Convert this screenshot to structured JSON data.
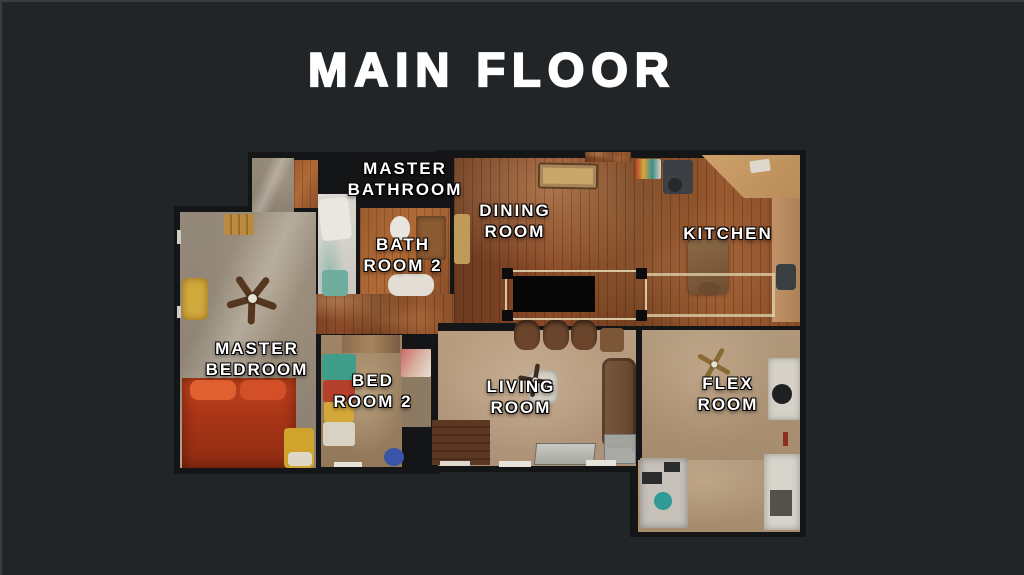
{
  "title": "MAIN FLOOR",
  "rooms": {
    "master_bathroom": {
      "line1": "MASTER",
      "line2": "BATHROOM"
    },
    "bath_room_2": {
      "line1": "BATH",
      "line2": "ROOM 2"
    },
    "dining_room": {
      "line1": "DINING",
      "line2": "ROOM"
    },
    "kitchen": {
      "line1": "KITCHEN"
    },
    "master_bedroom": {
      "line1": "MASTER",
      "line2": "BEDROOM"
    },
    "bed_room_2": {
      "line1": "BED",
      "line2": "ROOM 2"
    },
    "living_room": {
      "line1": "LIVING",
      "line2": "ROOM"
    },
    "flex_room": {
      "line1": "FLEX",
      "line2": "ROOM"
    }
  },
  "colors": {
    "background": "#222528",
    "walls": "#141517",
    "wood_floor": "#8a4a28",
    "carpet_gray": "#938879",
    "carpet_tan": "#b89c7f",
    "label_text": "#ffffff",
    "title_text": "#ffffff",
    "bed_red": "#b23b1a",
    "stair_opening": "#070707"
  }
}
